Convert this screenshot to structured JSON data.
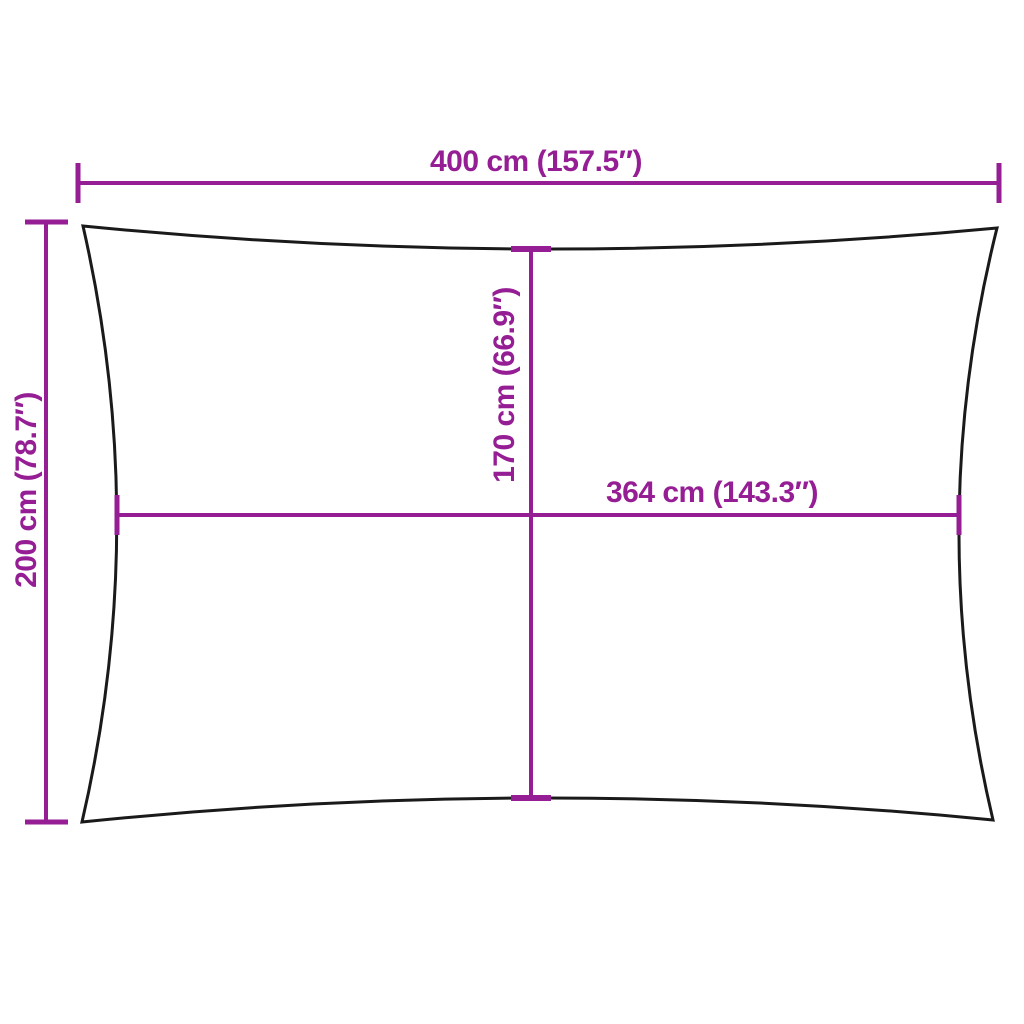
{
  "colors": {
    "dimension": "#951E95",
    "outline": "#1A1A1A",
    "background": "#FFFFFF"
  },
  "measurements": {
    "overall_width": {
      "label": "400 cm (157.5″)",
      "cm": "400",
      "inches": "157.5"
    },
    "overall_height": {
      "label": "200 cm (78.7″)",
      "cm": "200",
      "inches": "78.7"
    },
    "center_height": {
      "label": "170 cm (66.9″)",
      "cm": "170",
      "inches": "66.9"
    },
    "center_width": {
      "label": "364 cm (143.3″)",
      "cm": "364",
      "inches": "143.3"
    }
  }
}
